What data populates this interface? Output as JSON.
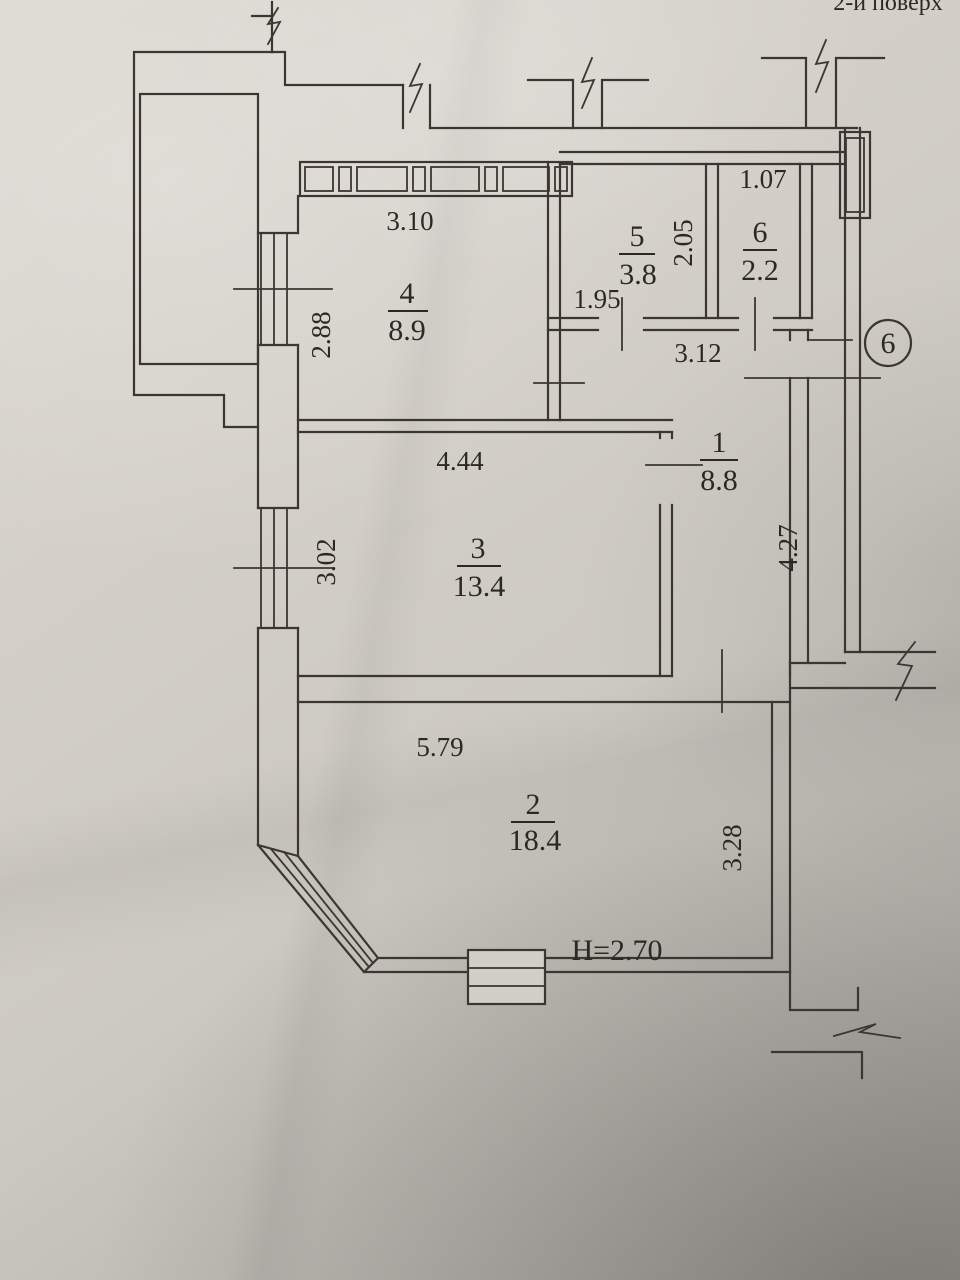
{
  "title": "2-й поверх",
  "axis_marker": "6",
  "rooms": [
    {
      "number": "1",
      "area": "8.8"
    },
    {
      "number": "2",
      "area": "18.4"
    },
    {
      "number": "3",
      "area": "13.4"
    },
    {
      "number": "4",
      "area": "8.9"
    },
    {
      "number": "5",
      "area": "3.8"
    },
    {
      "number": "6",
      "area": "2.2"
    }
  ],
  "dimensions": {
    "room4_top": "3.10",
    "room4_side": "2.88",
    "hall_small": "1.95",
    "room5_side": "2.05",
    "room6_top": "1.07",
    "hall_top": "3.12",
    "room3_top": "4.44",
    "room3_side": "3.02",
    "corridor_side": "4.27",
    "room2_top": "5.79",
    "room2_side": "3.28",
    "ceiling_height": "H=2.70"
  }
}
